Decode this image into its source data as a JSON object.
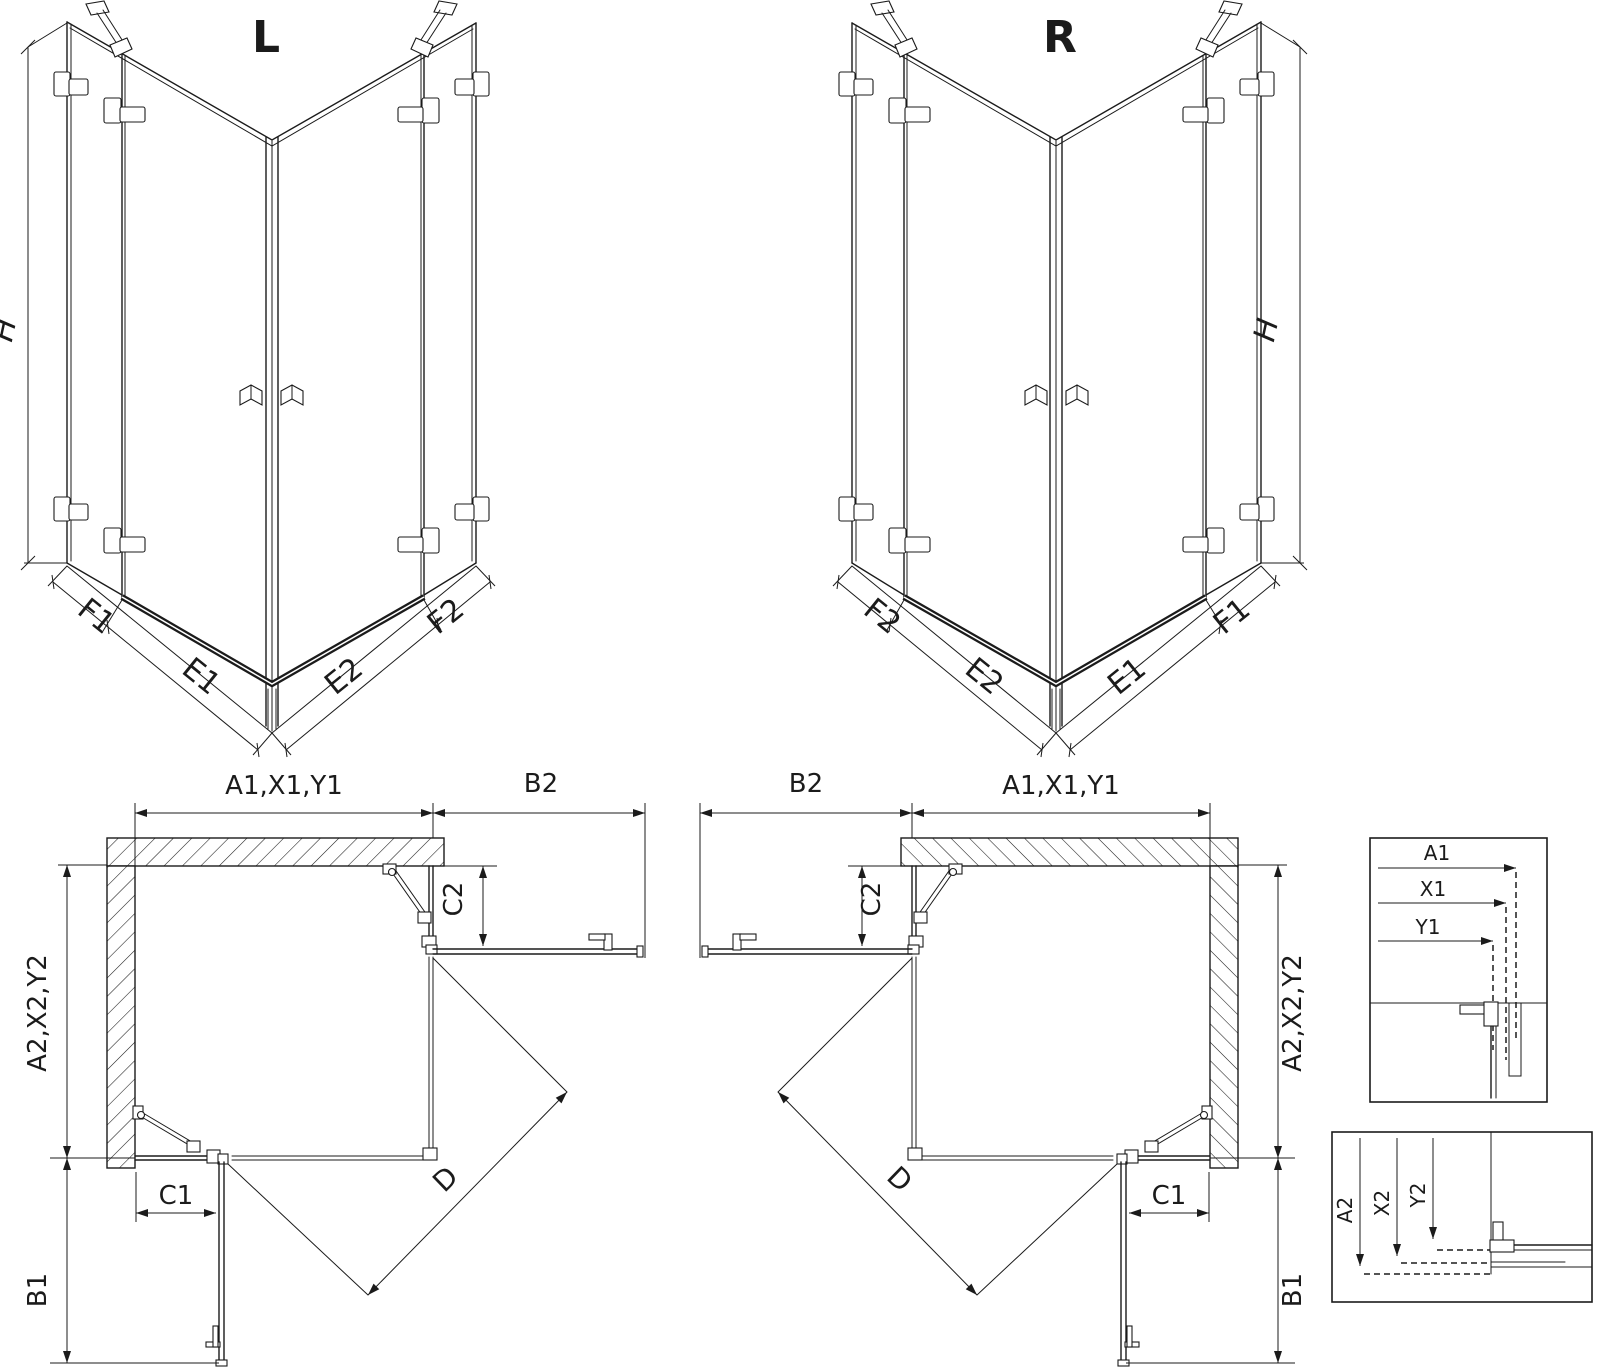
{
  "colors": {
    "ink": "#1b1b1b",
    "background": "#ffffff"
  },
  "views": {
    "iso_left": {
      "title": "L",
      "h": "H",
      "left_outer": "F1",
      "left_door": "E1",
      "right_door": "E2",
      "right_outer": "F2"
    },
    "iso_right": {
      "title": "R",
      "h": "H",
      "left_outer": "F2",
      "left_door": "E2",
      "right_door": "E1",
      "right_outer": "F1"
    },
    "plan_left": {
      "width": "A1,X1,Y1",
      "return_top": "B2",
      "depth": "A2,X2,Y2",
      "return_side": "B1",
      "fixed_top": "C2",
      "fixed_side": "C1",
      "diagonal": "D"
    },
    "plan_right": {
      "width": "A1,X1,Y1",
      "return_top": "B2",
      "depth": "A2,X2,Y2",
      "return_side": "B1",
      "fixed_top": "C2",
      "fixed_side": "C1",
      "diagonal": "D"
    },
    "detail_width": {
      "a": "A1",
      "x": "X1",
      "y": "Y1"
    },
    "detail_depth": {
      "a": "A2",
      "x": "X2",
      "y": "Y2"
    }
  }
}
